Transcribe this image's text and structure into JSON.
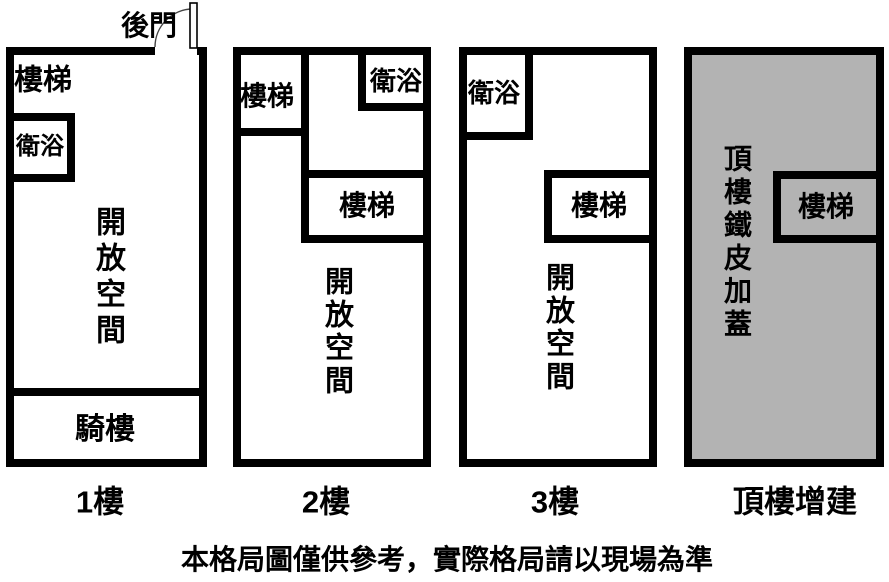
{
  "diagram": {
    "disclaimer": "本格局圖僅供參考，實際格局請以現場為準",
    "colors": {
      "wall": "#000000",
      "text": "#000000",
      "background": "#ffffff",
      "rooftop_fill": "#b3b3b3"
    },
    "floors": [
      {
        "label": "1樓",
        "back_door": "後門",
        "stairs": "樓梯",
        "bathroom": "衛浴",
        "open_space": "開放空間",
        "arcade": "騎樓"
      },
      {
        "label": "2樓",
        "stairs_top": "樓梯",
        "bathroom": "衛浴",
        "stairs_mid": "樓梯",
        "open_space": "開放空間"
      },
      {
        "label": "3樓",
        "bathroom": "衛浴",
        "stairs": "樓梯",
        "open_space": "開放空間"
      },
      {
        "label": "頂樓增建",
        "area": "頂樓鐵皮加蓋",
        "stairs": "樓梯"
      }
    ]
  }
}
